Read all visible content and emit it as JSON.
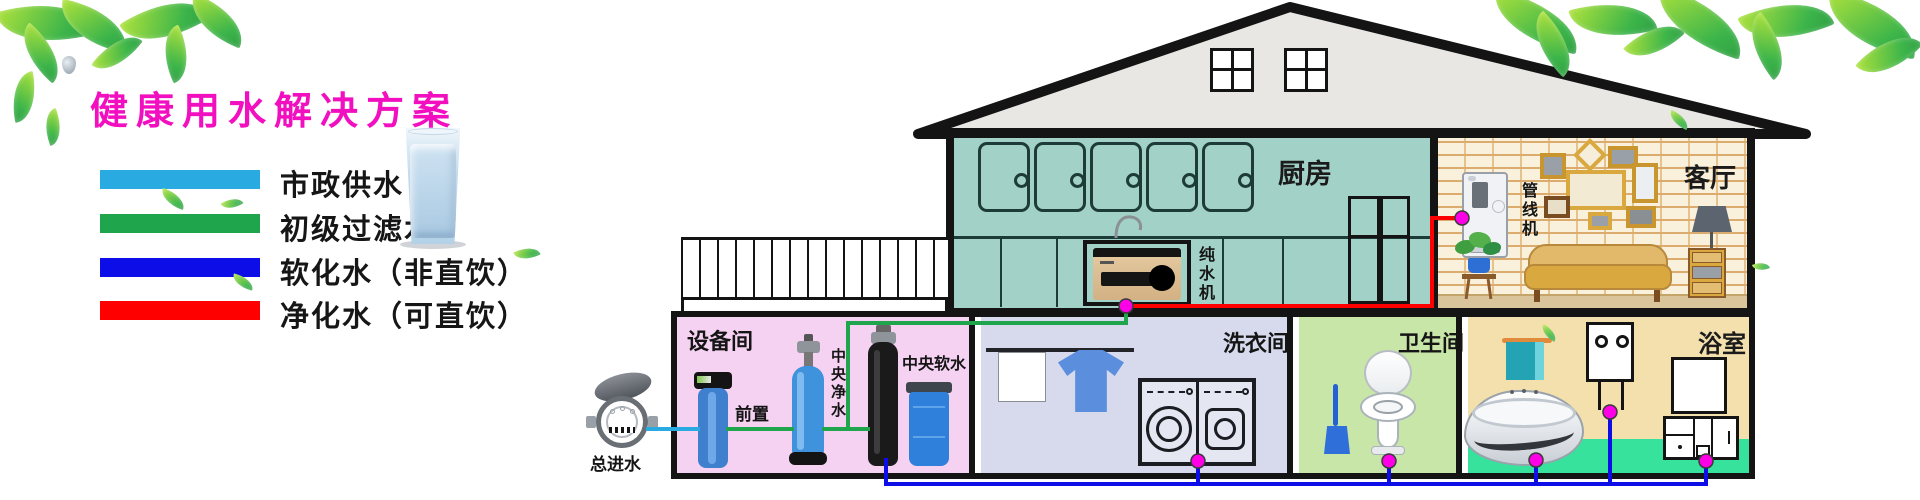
{
  "title": {
    "text": "健康用水解决方案",
    "color": "#F20FC0"
  },
  "legend": {
    "items": [
      {
        "label": "市政供水",
        "color": "#29ABE2"
      },
      {
        "label": "初级过滤水",
        "color": "#1FA64C"
      },
      {
        "label": "软化水（非直饮）",
        "color": "#0D0DE8"
      },
      {
        "label": "净化水（可直饮）",
        "color": "#FF0000"
      }
    ]
  },
  "pipe_colors": {
    "municipal": "#29ABE2",
    "filtered": "#1FA64C",
    "softened": "#0D0DE8",
    "purified": "#FF0000",
    "joint": "#FF00E6"
  },
  "diagram": {
    "source_label": "总进水",
    "rooms": {
      "equipment": {
        "name": "设备间",
        "prefilter": "前置",
        "purifier": "中央净水",
        "softener": "中央软水"
      },
      "kitchen": {
        "name": "厨房",
        "device": "纯水机"
      },
      "living": {
        "name": "客厅",
        "device": "管线机"
      },
      "laundry": {
        "name": "洗衣间"
      },
      "toilet": {
        "name": "卫生间"
      },
      "bathroom": {
        "name": "浴室"
      }
    }
  }
}
